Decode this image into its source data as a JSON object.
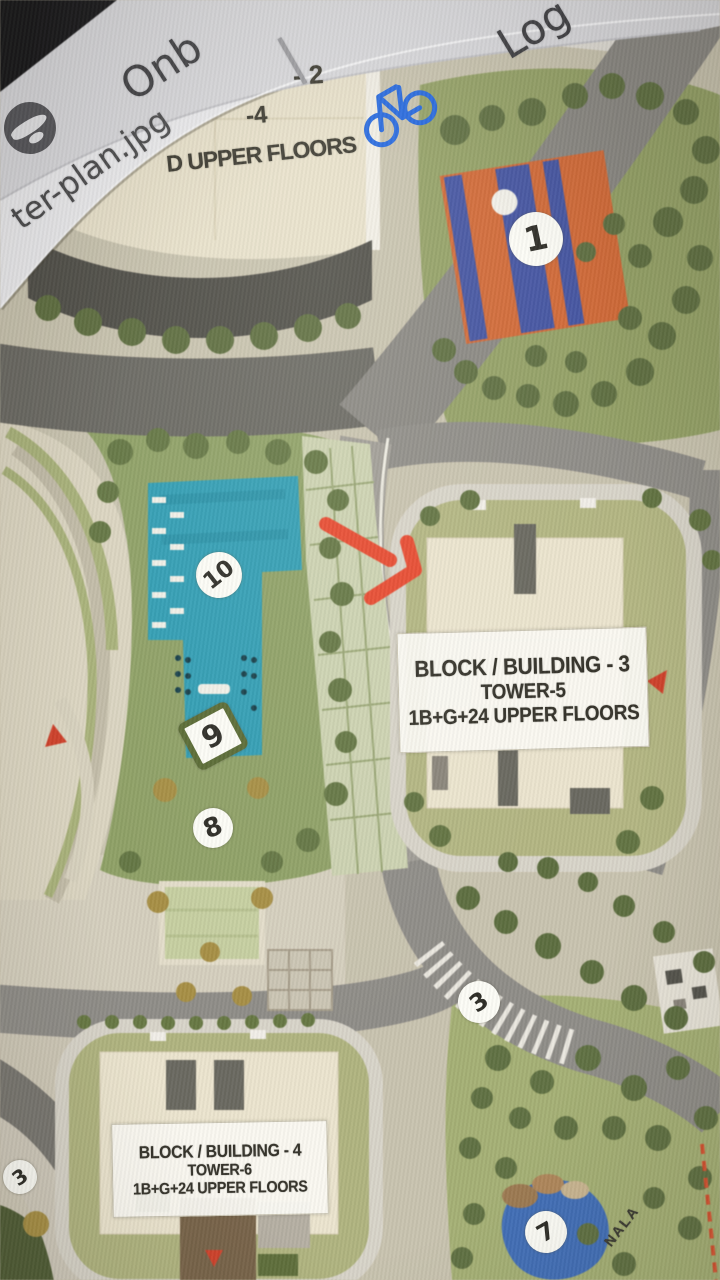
{
  "browser": {
    "bookmark_onb": {
      "label": "Onb",
      "icon": "globe-icon"
    },
    "separator": "|",
    "bookmark_log": {
      "label": "Log",
      "icon": "bicycle-icon"
    },
    "page_title_fragment": "ter-plan.jpg",
    "colors": {
      "bookmark_text": "#3f3f43",
      "icon_blue": "#2468e0",
      "bar_gray": "#d9d9dd",
      "tab_white": "#ececef"
    }
  },
  "map": {
    "buildings": {
      "top": {
        "line1": "- 2",
        "line2": "-4",
        "line3": "D UPPER FLOORS"
      },
      "block3": {
        "line1": "BLOCK / BUILDING - 3",
        "line2": "TOWER-5",
        "line3": "1B+G+24 UPPER FLOORS"
      },
      "block4": {
        "line1": "BLOCK / BUILDING - 4",
        "line2": "TOWER-6",
        "line3": "1B+G+24 UPPER FLOORS"
      }
    },
    "markers": {
      "court": "1",
      "pool": "10",
      "pool_deck": "9",
      "garden_plaza": "8",
      "road_mid": "3",
      "road_left": "3",
      "pond": "7"
    },
    "waterway_label": "NALA",
    "annotation": {
      "arrow_color": "#f2472b"
    },
    "colors": {
      "pool": "#2aa0b8",
      "court_orange": "#d86832",
      "court_blue": "#4355a8",
      "lawn": "#a5b170",
      "road": "#8f8d88",
      "building_cream": "#ece4cc",
      "boundary_red": "#e0512c"
    }
  }
}
